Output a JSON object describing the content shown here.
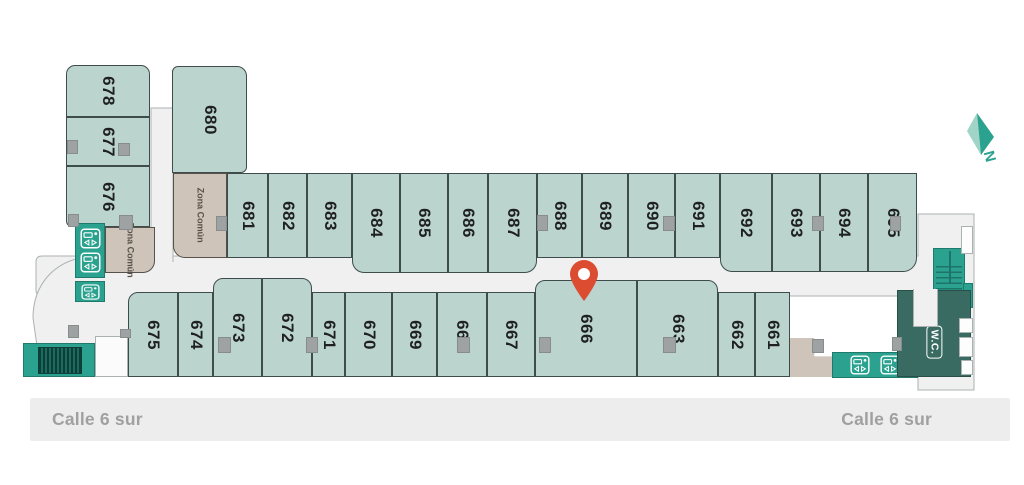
{
  "units": [
    {
      "label": "678"
    },
    {
      "label": "677"
    },
    {
      "label": "676"
    },
    {
      "label": "680"
    },
    {
      "label": "681"
    },
    {
      "label": "682"
    },
    {
      "label": "683"
    },
    {
      "label": "684"
    },
    {
      "label": "685"
    },
    {
      "label": "686"
    },
    {
      "label": "687"
    },
    {
      "label": "688"
    },
    {
      "label": "689"
    },
    {
      "label": "690"
    },
    {
      "label": "691"
    },
    {
      "label": "692"
    },
    {
      "label": "693"
    },
    {
      "label": "694"
    },
    {
      "label": "695"
    },
    {
      "label": "675"
    },
    {
      "label": "674"
    },
    {
      "label": "673"
    },
    {
      "label": "672"
    },
    {
      "label": "671"
    },
    {
      "label": "670"
    },
    {
      "label": "669"
    },
    {
      "label": "668"
    },
    {
      "label": "667"
    },
    {
      "label": "666"
    },
    {
      "label": "663"
    },
    {
      "label": "662"
    },
    {
      "label": "661"
    }
  ],
  "zones": [
    {
      "label": "Zona Común"
    },
    {
      "label": "Zona Común"
    }
  ],
  "wc": {
    "label": "W.C."
  },
  "compass": {
    "label": "N"
  },
  "streets": {
    "left": "Calle 6 sur",
    "right": "Calle 6 sur"
  },
  "marker": {
    "name": "location-pin",
    "color": "#DB4C31"
  },
  "icons": {
    "elevator": "elevator-icon",
    "stairs": "stairs-icon",
    "escalator": "escalator-icon"
  },
  "colors": {
    "unit": "#BCD4CE",
    "unit_border": "#3E4D4C",
    "zone": "#CEC4B9",
    "zone_border": "#56524B",
    "walkway": "#F0F0F0",
    "walkway_border": "#ACB2B2",
    "teal": "#2BA18F",
    "teal_border": "#1F7A6C",
    "dark_teal": "#3A6B62",
    "pillar": "#9EA2A3",
    "street_bg": "#EDEDED",
    "street_text": "#A0A0A0",
    "pin": "#DB4C31",
    "label_text": "#1F2121"
  }
}
